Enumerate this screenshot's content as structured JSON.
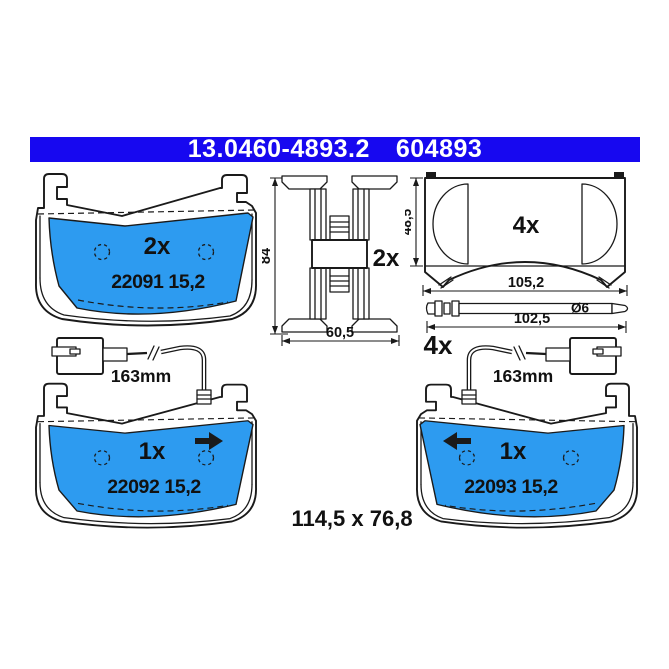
{
  "header": {
    "part_number": "13.0460-4893.2",
    "reference": "604893"
  },
  "colors": {
    "header_bg": "#1708F0",
    "pad_blue": "#2D9BF0",
    "line": "#1A1A1A",
    "text": "#111111"
  },
  "pads": {
    "pad_top": {
      "quantity": "2x",
      "wva_label": "22091 15,2"
    },
    "pad_left": {
      "quantity": "1x",
      "wva_label": "22092 15,2",
      "sensor_length": "163mm"
    },
    "pad_right": {
      "quantity": "1x",
      "wva_label": "22093 15,2",
      "sensor_length": "163mm"
    }
  },
  "clip": {
    "quantity": "2x",
    "height": "84",
    "width": "60,5"
  },
  "shim": {
    "quantity": "4x",
    "height": "48,5",
    "width": "105,2"
  },
  "pin": {
    "quantity": "4x",
    "length": "102,5",
    "diameter": "Ø6"
  },
  "footer": {
    "pad_size": "114,5 x 76,8"
  }
}
